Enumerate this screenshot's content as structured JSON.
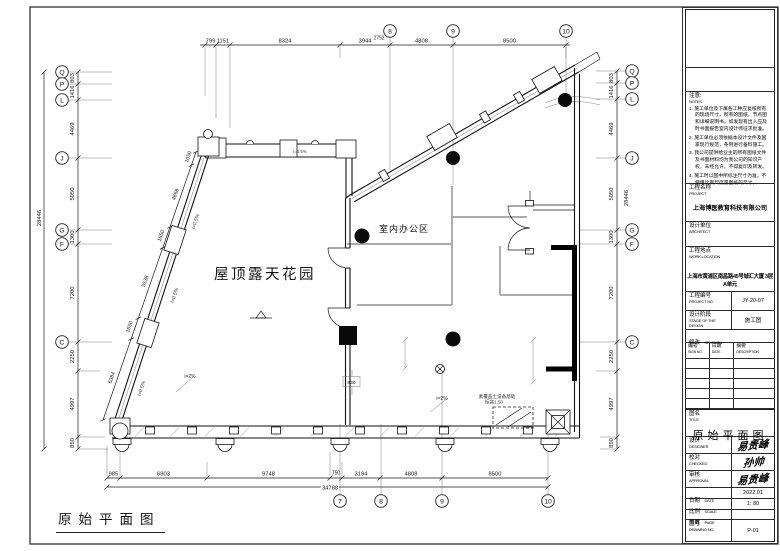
{
  "sheet": {
    "caption": "原始平面图"
  },
  "plan": {
    "labels": {
      "garden": "屋顶露天花园",
      "office": "室内办公区",
      "equip1": "素覆盖土设备基础",
      "equip2": "标高1.50",
      "slope_05": "i=0.5%",
      "slope_2": "i=2%"
    },
    "grid": {
      "top": [
        "8",
        "9",
        "10"
      ],
      "bottom": [
        "7",
        "8",
        "9",
        "10"
      ],
      "side": [
        "Q",
        "P",
        "L",
        "J",
        "G",
        "F",
        "C"
      ]
    },
    "dims": {
      "top": [
        "799",
        "1151",
        "8324",
        "3944",
        "4808",
        "8500"
      ],
      "top_offset": "2752",
      "left": [
        "803",
        "1416",
        "4469",
        "5050",
        "1300",
        "7200",
        "2250",
        "4997",
        "850"
      ],
      "side_total": "28446",
      "bottom": [
        "985",
        "6803",
        "9748",
        "750",
        "3194",
        "4808",
        "8500"
      ],
      "bottom_total": "34788",
      "slant": [
        "1050",
        "4868",
        "1650",
        "5538",
        "1650",
        "6384"
      ],
      "interior": "830"
    }
  },
  "titleblock": {
    "notes": {
      "label_cn": "注意:",
      "label_en": "NOTES:",
      "items": [
        "1. 施工单位及下属各工种应复核所有的现场尺寸，所有的图纸，节点图和详细说明书，如发现有出入应及时书面报告室内设计师征求批准。",
        "2. 施工单位必须依据本设计文件及国家现行规范，条例进行备料施工。",
        "3. 我公司提供给业主的所有图纸文件及书面材料均为我公司的知识产权，未经允许，不得复印及转发。",
        "4. 施工时以图中所标注尺寸为准，不使用比例尺度量图纸的尺寸。"
      ]
    },
    "project": {
      "label_cn": "工程名称",
      "label_en": "PROJECT",
      "value": "上海博医教育科技有限公司"
    },
    "architect": {
      "label_cn": "设计单位",
      "label_en": "ARCHITECT",
      "value": ""
    },
    "location": {
      "label_cn": "工程地点",
      "label_en": "WORK LOCATION",
      "value": "上海市黄浦区南昌路45号城汇大厦 3层A单元"
    },
    "project_no": {
      "label_cn": "工程编号",
      "label_en": "PROJECT NO.",
      "value": "JY-20-07"
    },
    "stage": {
      "label_cn": "设计阶段",
      "label_en": "STAGE OF THE DESIGN",
      "value": "施工图"
    },
    "revision": {
      "label_cn": "修改",
      "label_en": "REVISION",
      "col1_cn": "编号",
      "col1_en": "SIGN NO.",
      "col2_cn": "日期",
      "col2_en": "DATE",
      "col3_cn": "摘要",
      "col3_en": "DESCRIPTION"
    },
    "title": {
      "label_cn": "图名",
      "label_en": "TITLE",
      "value": "原始平面图"
    },
    "designer": {
      "label_cn": "设计",
      "label_en": "DESIGNER",
      "value": "易贵峰"
    },
    "checked": {
      "label_cn": "校对",
      "label_en": "CHECKED",
      "value": "孙帅"
    },
    "approval": {
      "label_cn": "审核",
      "label_en": "APPROVAL",
      "value": "易贵峰"
    },
    "date": {
      "label_cn": "日期",
      "label_en": "DATE",
      "value": "2022.01"
    },
    "scale": {
      "label_cn": "比例",
      "label_en": "SCALE",
      "value": "1: 80"
    },
    "page": {
      "label_cn": "页数",
      "label_en": "PAGE",
      "value": ""
    },
    "drawing_no": {
      "label_cn": "图号",
      "label_en": "DRAWING NO.",
      "value": "P-01"
    }
  }
}
